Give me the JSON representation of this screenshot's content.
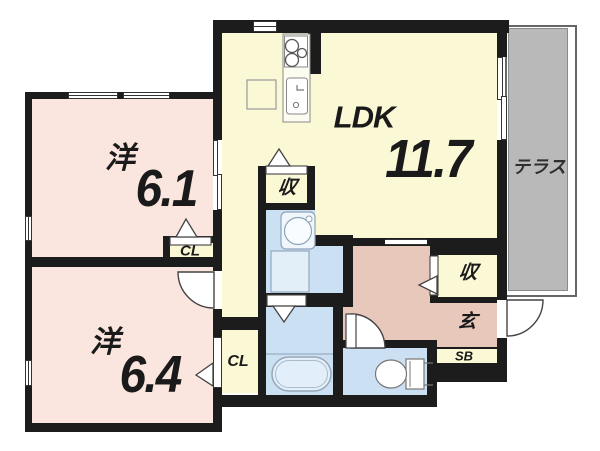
{
  "floorplan": {
    "type": "japanese-apartment-floor-plan",
    "labels": {
      "ldk": "LDK",
      "ldk_area": "11.7",
      "west1": "洋",
      "west1_area": "6.1",
      "west2": "洋",
      "west2_area": "6.4",
      "terrace": "テラス",
      "storage1": "収",
      "storage2": "収",
      "entrance": "玄",
      "shoe_box": "SB",
      "closet1": "CL",
      "closet2": "CL"
    },
    "colors": {
      "wall": "#1c1c1c",
      "western_room_fill": "#fae5df",
      "ldk_fill": "#fbf8d6",
      "wet_area_fill": "#cbe0f2",
      "entrance_hall_fill": "#e8c8bb",
      "terrace_fill": "#b9b9b9",
      "background": "#ffffff"
    }
  }
}
